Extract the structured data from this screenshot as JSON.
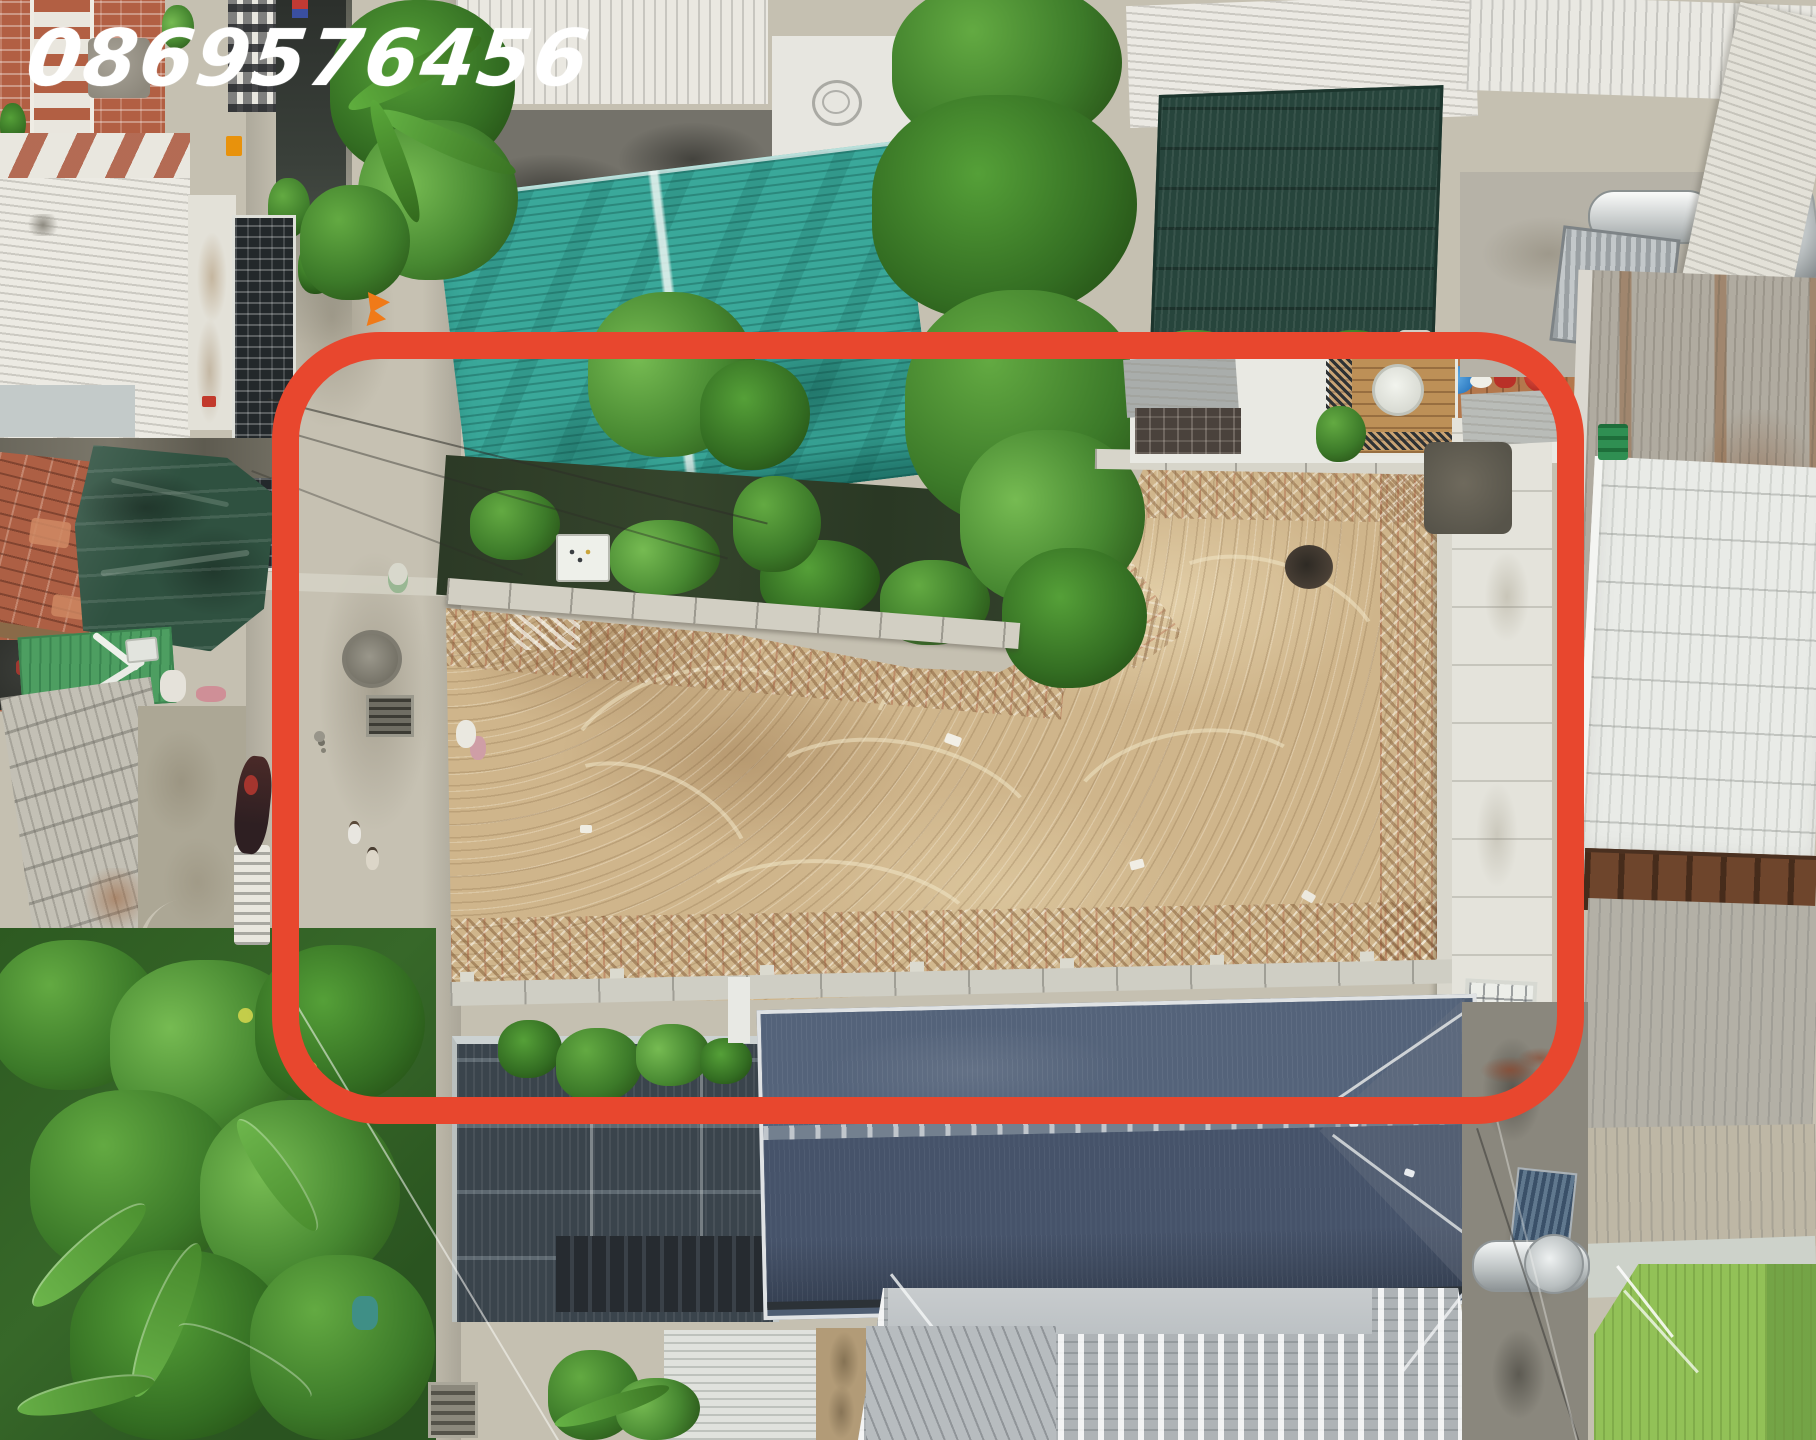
{
  "image": {
    "kind": "aerial-drone-photo",
    "subject": "vacant residential land plot outlined for sale in a dense neighborhood",
    "width_px": 1816,
    "height_px": 1440
  },
  "watermark": {
    "phone_number": "0869576456",
    "color": "#ffffff",
    "position": "top-left",
    "style": "handwritten italic"
  },
  "annotation": {
    "shape": "rounded-rectangle-outline",
    "purpose": "highlights the vacant dirt lot and its access alley",
    "color": "#e8472e",
    "stroke_px": 27
  },
  "scene": {
    "highlighted_plot": {
      "surface": "bare sandy dirt with excavator track swirls, rubble bands along edges, small dark pit",
      "boundaries": "low concrete walls on all sides, concrete alley on the west"
    },
    "landmarks": [
      {
        "name": "concrete-alley",
        "detail": "manhole cover, drain grates, two pedestrians, parked motorbike, utility pole"
      },
      {
        "name": "teal-corrugated-roof",
        "detail": "weathered teal metal roof north of plot"
      },
      {
        "name": "green-shade-net-awning",
        "detail": "dark green mesh over white rooftop, north-east"
      },
      {
        "name": "rooftop-terrace",
        "detail": "wooden balcony with round table, terracotta floor, blue and red buckets"
      },
      {
        "name": "solar-water-heaters",
        "detail": "two tanks with collector panels on concrete roof deck"
      },
      {
        "name": "blue-grey-tile-hip-roof",
        "detail": "large house immediately south of plot"
      },
      {
        "name": "dark-metal-roof-building",
        "detail": "dark corrugated structure south-west of plot"
      },
      {
        "name": "orange-tile-roof-with-tarp",
        "detail": "old tile roof draped with dark green tarp, west side"
      },
      {
        "name": "banana-grove",
        "detail": "dense tropical vegetation, south-west corner"
      },
      {
        "name": "green-sport-court-roof",
        "detail": "bright green striped surface, south-east corner"
      },
      {
        "name": "rusty-corrugated-roofs",
        "detail": "east side metal roofs with rust streaks"
      }
    ]
  },
  "palette": {
    "dirt": "#cfb58b",
    "alley_concrete": "#c6c1b2",
    "teal_roof": "#3aa89a",
    "tarp_green": "#2f5140",
    "mesh_awning_green": "#24423a",
    "blue_tile_roof": "#4e5d72",
    "dark_metal_roof": "#3a444c",
    "vegetation": "#3f7c2b",
    "green_court": "#92c157",
    "rust": "#8a5b38",
    "white_roof": "#eceae3",
    "brick": "#b25f43",
    "annotation_red": "#e8472e"
  }
}
